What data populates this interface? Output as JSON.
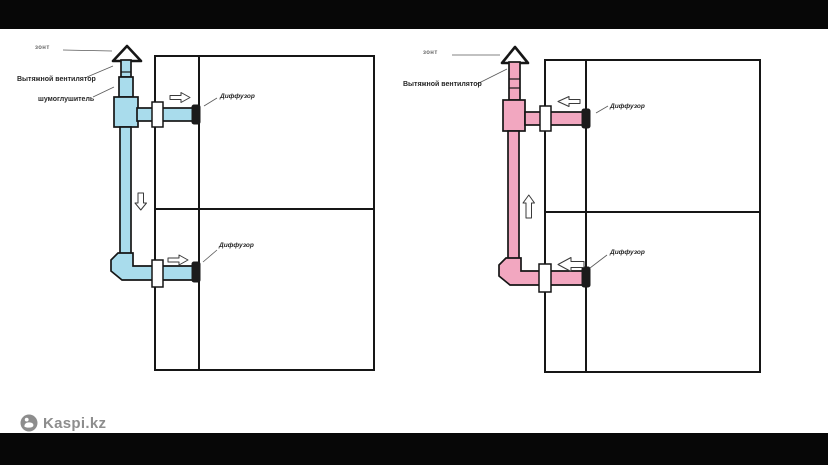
{
  "colors": {
    "letterbox": "#070707",
    "canvas": "#ffffff",
    "outline": "#161616",
    "watermark": "#8d8d8d"
  },
  "watermark": {
    "text": "Kaspi.kz",
    "icon": "kaspi-logo"
  },
  "diagrams": [
    {
      "id": "left-scheme",
      "pipe_color": "#a9dcec",
      "labels": {
        "hood": "зонт",
        "fan": "Вытяжной вентилятор",
        "silencer": "шумоглушитель",
        "diffuser_upper": "Диффузор",
        "diffuser_lower": "Диффузор"
      },
      "arrows": [
        "right",
        "down",
        "right"
      ]
    },
    {
      "id": "right-scheme",
      "pipe_color": "#f2a7c0",
      "labels": {
        "hood": "зонт",
        "fan": "Вытяжной вентилятор",
        "diffuser_upper": "Диффузор",
        "diffuser_lower": "Диффузор"
      },
      "arrows": [
        "left",
        "up",
        "left"
      ]
    }
  ]
}
